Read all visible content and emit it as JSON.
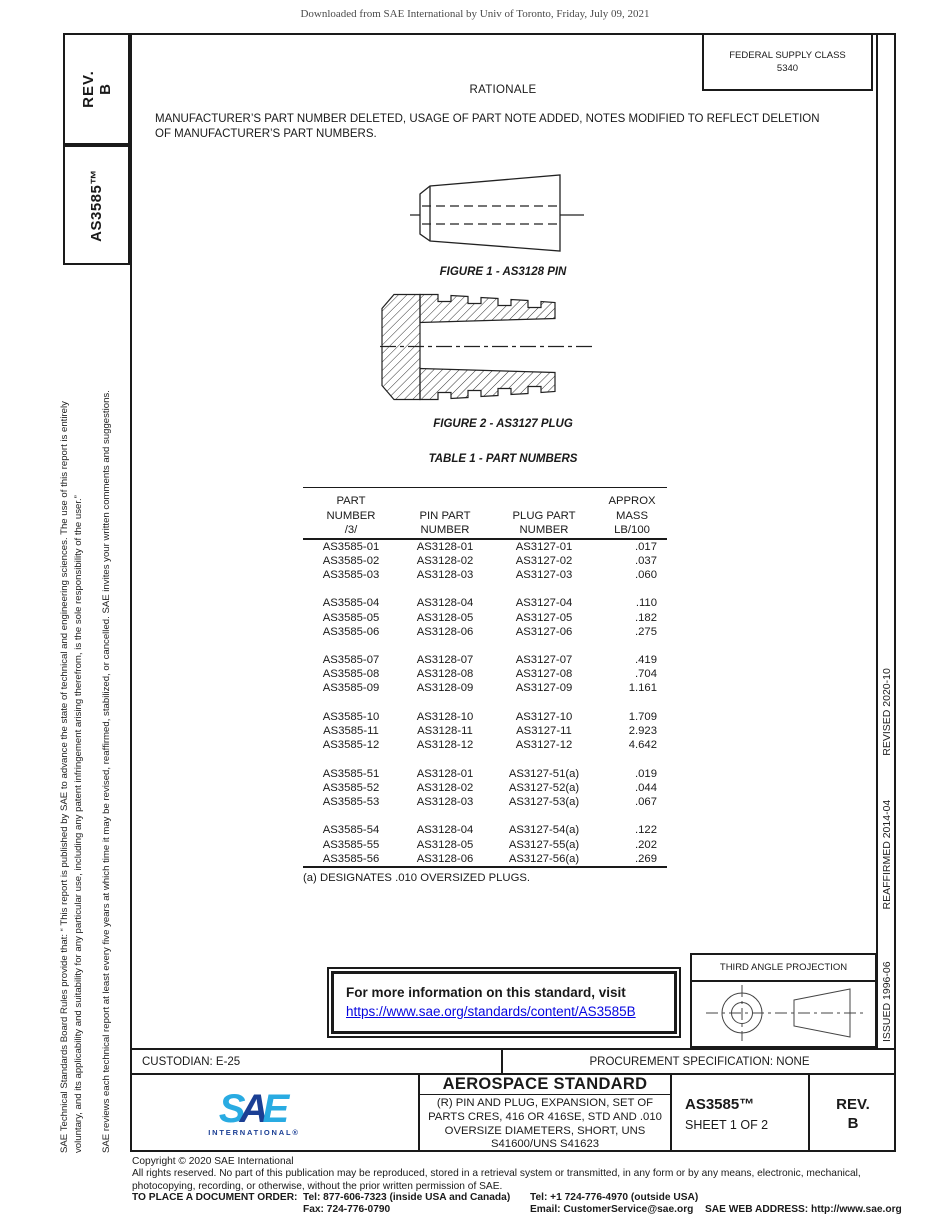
{
  "page": {
    "watermark": "Downloaded from SAE International by Univ of Toronto, Friday, July 09, 2021"
  },
  "left_margin": {
    "rev_line1": "REV.",
    "rev_line2": "B",
    "doc_number": "AS3585™",
    "disclaimer_line1": "SAE Technical Standards Board Rules provide that: “ This report is published by SAE to advance the state of technical and engineering sciences. The use of this report is entirely",
    "disclaimer_line2": "voluntary, and its applicability and suitability for any particular use, including any patent infringement arising therefrom, is the sole responsibility of the user.”",
    "review_note": "SAE reviews each technical report at least every five years at which time it may be revised, reaffirmed, stabilized, or cancelled. SAE invites your written comments and suggestions."
  },
  "right_margin": {
    "issued": "ISSUED 1996-06",
    "reaffirmed": "REAFFIRMED 2014-04",
    "revised": "REVISED 2020-10"
  },
  "header": {
    "fsc_label": "FEDERAL SUPPLY CLASS",
    "fsc_value": "5340",
    "rationale_title": "RATIONALE",
    "rationale_text": "MANUFACTURER’S PART NUMBER DELETED, USAGE OF PART NOTE ADDED, NOTES MODIFIED TO REFLECT DELETION OF MANUFACTURER’S PART NUMBERS."
  },
  "figures": {
    "figure1_caption": "FIGURE 1 - AS3128 PIN",
    "figure2_caption": "FIGURE 2 - AS3127 PLUG"
  },
  "table": {
    "title": "TABLE 1 - PART NUMBERS",
    "header_lines": [
      [
        "PART",
        "",
        "",
        "APPROX"
      ],
      [
        "NUMBER",
        "PIN PART",
        "PLUG PART",
        "MASS"
      ],
      [
        "/3/",
        "NUMBER",
        "NUMBER",
        "LB/100"
      ]
    ],
    "groups": [
      [
        [
          "AS3585-01",
          "AS3128-01",
          "AS3127-01",
          ".017"
        ],
        [
          "AS3585-02",
          "AS3128-02",
          "AS3127-02",
          ".037"
        ],
        [
          "AS3585-03",
          "AS3128-03",
          "AS3127-03",
          ".060"
        ]
      ],
      [
        [
          "AS3585-04",
          "AS3128-04",
          "AS3127-04",
          ".110"
        ],
        [
          "AS3585-05",
          "AS3128-05",
          "AS3127-05",
          ".182"
        ],
        [
          "AS3585-06",
          "AS3128-06",
          "AS3127-06",
          ".275"
        ]
      ],
      [
        [
          "AS3585-07",
          "AS3128-07",
          "AS3127-07",
          ".419"
        ],
        [
          "AS3585-08",
          "AS3128-08",
          "AS3127-08",
          ".704"
        ],
        [
          "AS3585-09",
          "AS3128-09",
          "AS3127-09",
          "1.161"
        ]
      ],
      [
        [
          "AS3585-10",
          "AS3128-10",
          "AS3127-10",
          "1.709"
        ],
        [
          "AS3585-11",
          "AS3128-11",
          "AS3127-11",
          "2.923"
        ],
        [
          "AS3585-12",
          "AS3128-12",
          "AS3127-12",
          "4.642"
        ]
      ],
      [
        [
          "AS3585-51",
          "AS3128-01",
          "AS3127-51(a)",
          ".019"
        ],
        [
          "AS3585-52",
          "AS3128-02",
          "AS3127-52(a)",
          ".044"
        ],
        [
          "AS3585-53",
          "AS3128-03",
          "AS3127-53(a)",
          ".067"
        ]
      ],
      [
        [
          "AS3585-54",
          "AS3128-04",
          "AS3127-54(a)",
          ".122"
        ],
        [
          "AS3585-55",
          "AS3128-05",
          "AS3127-55(a)",
          ".202"
        ],
        [
          "AS3585-56",
          "AS3128-06",
          "AS3127-56(a)",
          ".269"
        ]
      ]
    ],
    "footnote": "(a)  DESIGNATES .010 OVERSIZED PLUGS."
  },
  "info_box": {
    "text": "For more information on this standard, visit",
    "link": "https://www.sae.org/standards/content/AS3585B"
  },
  "projection_box": {
    "title": "THIRD ANGLE PROJECTION"
  },
  "footer": {
    "custodian": "CUSTODIAN: E-25",
    "procurement": "PROCUREMENT SPECIFICATION: NONE",
    "logo_s": "S",
    "logo_a": "A",
    "logo_e": "E",
    "logo_sub": "INTERNATIONAL®",
    "doc_type": "AEROSPACE STANDARD",
    "doc_subtitle": "(R) PIN AND PLUG, EXPANSION, SET OF PARTS CRES, 416 OR 416SE, STD AND .010 OVERSIZE DIAMETERS, SHORT, UNS S41600/UNS S41623",
    "doc_number": "AS3585™",
    "sheet": "SHEET 1 OF 2",
    "rev_label": "REV.",
    "rev_value": "B"
  },
  "copyright": {
    "line1": "Copyright © 2020 SAE International",
    "line2": "All rights reserved. No part of this publication may be reproduced, stored in a retrieval system or transmitted, in any form or by any means, electronic, mechanical, photocopying, recording, or otherwise, without the prior written permission of SAE.",
    "order_label": "TO PLACE A DOCUMENT ORDER:",
    "tel_inside": "Tel: 877-606-7323 (inside USA and Canada)",
    "tel_outside": "Tel: +1 724-776-4970 (outside USA)",
    "fax": "Fax: 724-776-0790",
    "email": "Email: CustomerService@sae.org",
    "web": "SAE WEB ADDRESS: http://www.sae.org"
  },
  "colors": {
    "logo_light_blue": "#29ABE2",
    "logo_dark_blue": "#1B3F94",
    "link_blue": "#0606e0"
  }
}
